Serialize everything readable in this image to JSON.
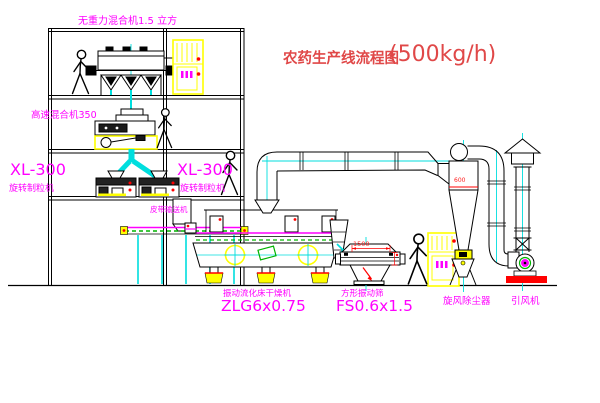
{
  "title": {
    "zh": "农药生产线流程图",
    "capacity": "(500kg/h)"
  },
  "labels": {
    "mixer_top": "无重力混合机1.5 立方",
    "mixer_high_speed": "高速混合机350",
    "granulator_model_left": "XL-300",
    "granulator_name_left": "旋转制粒机",
    "granulator_model_right": "XL-300",
    "granulator_name_right": "旋转制粒机",
    "belt_conveyor": "皮带输送机",
    "dryer_name": "振动流化床干燥机",
    "dryer_model": "ZLG6x0.75",
    "screen_name": "方形振动筛",
    "screen_model": "FS0.6x1.5",
    "cyclone_name": "旋风除尘器",
    "fan_name": "引风机"
  },
  "dimensions": {
    "screen_length": "1500",
    "cyclone_marking": "600"
  },
  "colors": {
    "label_magenta": "#ff00ff",
    "title_red": "#e04848",
    "line_black": "#000000",
    "centerline_cyan": "#00dede",
    "equipment_yellow": "#ffff00",
    "accent_red": "#ff0000",
    "belt_green": "#00b400",
    "background": "#ffffff"
  }
}
